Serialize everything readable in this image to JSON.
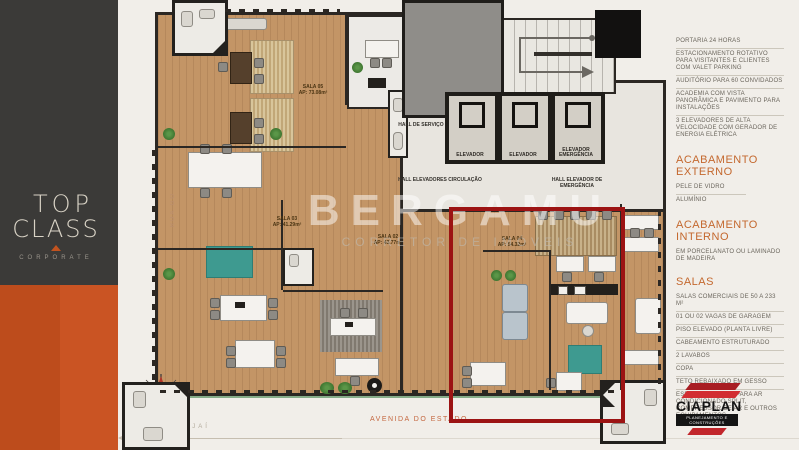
{
  "sidebar": {
    "logo_line1": "TOP",
    "logo_line2": "CLASS",
    "logo_sub": "CORPORATE"
  },
  "plan": {
    "watermark": {
      "line1": "BERGAMU",
      "line2": "CORRETOR DE IMÓVEIS"
    },
    "streets": {
      "left": "RUA GO",
      "bottom": "AVENIDA DO ESTADO",
      "direction": "SENTIDO ITAJAÍ"
    },
    "halls": {
      "service": "HALL DE SERVIÇO",
      "circulation": "HALL ELEVADORES CIRCULAÇÃO",
      "emergency": "HALL ELEVADOR DE EMERGÊNCIA"
    },
    "elevators": [
      {
        "label": "ELEVADOR"
      },
      {
        "label": "ELEVADOR"
      },
      {
        "label": "ELEVADOR EMERGÊNCIA"
      }
    ],
    "rooms": [
      {
        "name": "SALA 05",
        "area": "AP: 73.08m²"
      },
      {
        "name": "SALA 03",
        "area": "AP: 41.29m²"
      },
      {
        "name": "SALA 02",
        "area": "AP: 43.77m²"
      },
      {
        "name": "SALA 04",
        "area": "AP: 54.32m²"
      }
    ]
  },
  "specs": {
    "features": [
      "PORTARIA 24 HORAS",
      "ESTACIONAMENTO ROTATIVO PARA VISITANTES E CLIENTES COM VALET PARKING",
      "AUDITÓRIO PARA 60 CONVIDADOS",
      "ACADEMIA COM VISTA PANORÂMICA E PAVIMENTO PARA INSTALAÇÕES",
      "3 ELEVADORES DE ALTA VELOCIDADE COM GERADOR DE ENERGIA ELÉTRICA"
    ],
    "acabamento_externo": {
      "title": "ACABAMENTO EXTERNO",
      "items": [
        "PELE DE VIDRO",
        "ALUMÍNIO"
      ]
    },
    "acabamento_interno": {
      "title": "ACABAMENTO INTERNO",
      "items": [
        "EM PORCELANATO OU LAMINADO DE MADEIRA"
      ]
    },
    "salas": {
      "title": "SALAS",
      "items": [
        "SALAS COMERCIAIS DE 50 A 233 M²",
        "01 OU 02 VAGAS DE GARAGEM",
        "PISO ELEVADO (PLANTA LIVRE)",
        "CABEAMENTO ESTRUTURADO",
        "2 LAVABOS",
        "COPA",
        "TETO REBAIXADO EM GESSO",
        "ESPAÇO EXTERNO PARA AR CONDICIONADO SPLIT, COMPRESSOR DE AR E OUTROS EQUIPAMENTOS"
      ]
    }
  },
  "brand": {
    "name": "CIAPLAN",
    "tagline": "PLANEJAMENTO E CONSTRUÇÕES"
  },
  "colors": {
    "accent_orange": "#c4682e",
    "sidebar_dark": "#3b3a38",
    "sidebar_orange": "#bd4c1c",
    "highlight_red": "#9c1313",
    "brand_red": "#d22d31",
    "wood_floor": "#c39566",
    "teal_rug": "#3e9a90"
  }
}
